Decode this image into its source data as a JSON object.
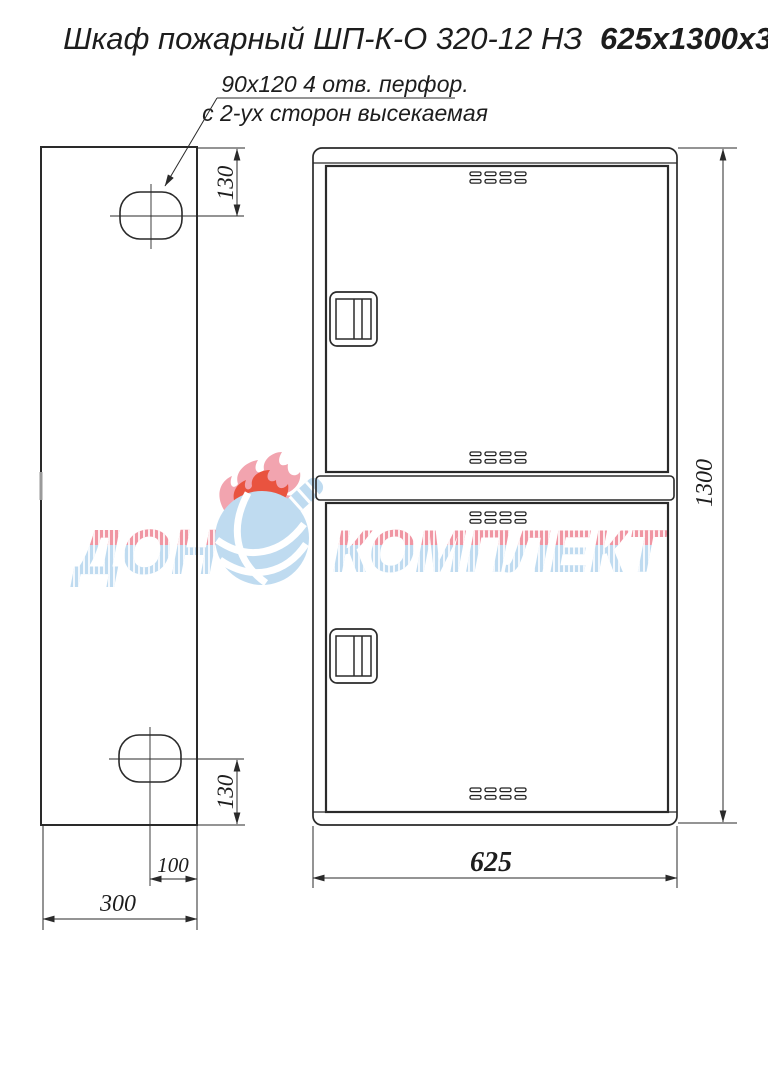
{
  "title": {
    "model": "Шкаф пожарный ШП-К-О 320-12 НЗ",
    "size": "625x1300x300"
  },
  "note": {
    "line1": "90x120  4 отв. перфор.",
    "line2": "с 2-ух сторон высекаемая"
  },
  "dims": {
    "side_top_offset": "130",
    "side_bottom_offset": "130",
    "hole_to_edge": "100",
    "depth": "300",
    "width": "625",
    "height": "1300"
  },
  "watermark": {
    "left": "ДОН",
    "right": "КОМПЛЕКТ"
  },
  "colors": {
    "line": "#2a2a2a",
    "watermark_red": "#f0919f",
    "watermark_blue": "#bcdaf0",
    "flame_red": "#e84a35"
  }
}
